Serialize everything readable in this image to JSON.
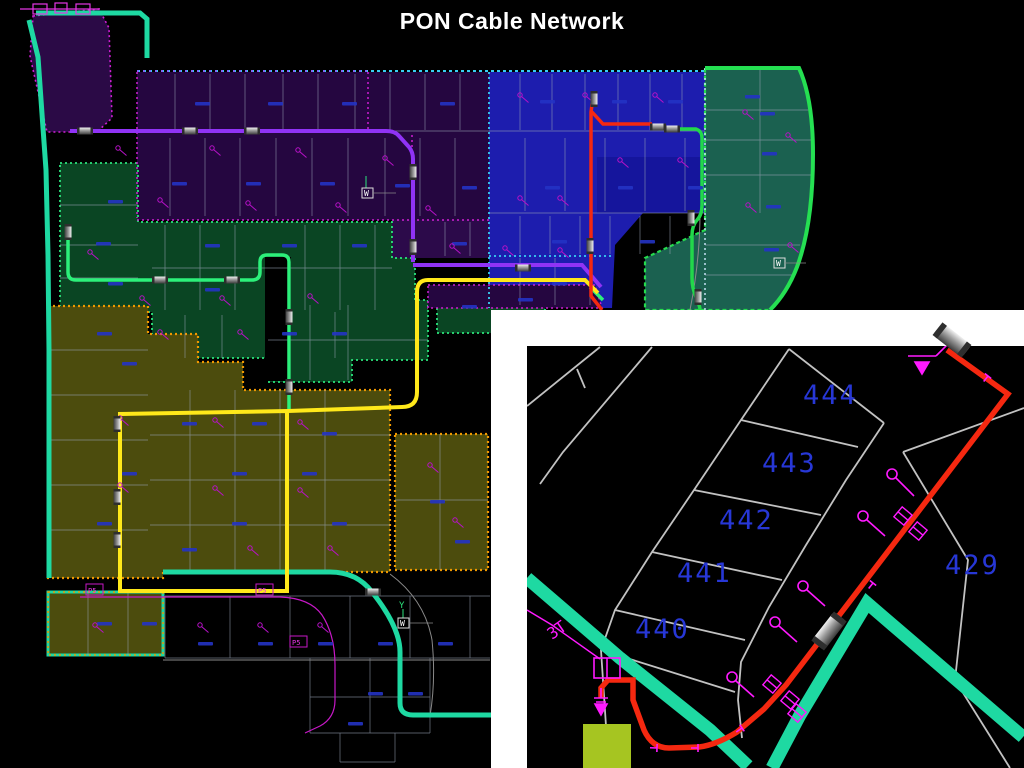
{
  "title": "PON Cable Network",
  "main_map": {
    "p5_labels": [
      "P5",
      "P5",
      "P5"
    ],
    "axis_marker_w": "W",
    "axis_marker_y": "Y"
  },
  "inset": {
    "lots": [
      {
        "label": "444"
      },
      {
        "label": "443"
      },
      {
        "label": "442"
      },
      {
        "label": "441"
      },
      {
        "label": "440"
      },
      {
        "label": "429"
      }
    ],
    "cable_tag": "3T"
  },
  "colors": {
    "background": "#000000",
    "title_text": "#ffffff",
    "road_edge_turquoise": "#1ed9a2",
    "cable_violet": "#9033f5",
    "cable_yellow": "#ffe81a",
    "cable_red": "#f52810",
    "cable_spring_green": "#2cf07a",
    "cable_green_right": "#22d84a",
    "zone_purple": "#250640",
    "zone_blue": "#1d1dae",
    "zone_navy_block": "#15159c",
    "zone_teal": "#1b6150",
    "zone_green": "#0a4523",
    "zone_olive": "#4c4c0d",
    "border_orange": "#ef9800",
    "border_magenta": "#cf1fd4",
    "border_cyan": "#38cef2",
    "lot_number_blue": "#2737d6",
    "symbol_magenta": "#ff1aff",
    "splice_gray": "#bbbbbb",
    "inset_green_square": "#a6c521",
    "inset_border_white": "#ffffff",
    "parcel_line_gray": "#97a2b4"
  }
}
